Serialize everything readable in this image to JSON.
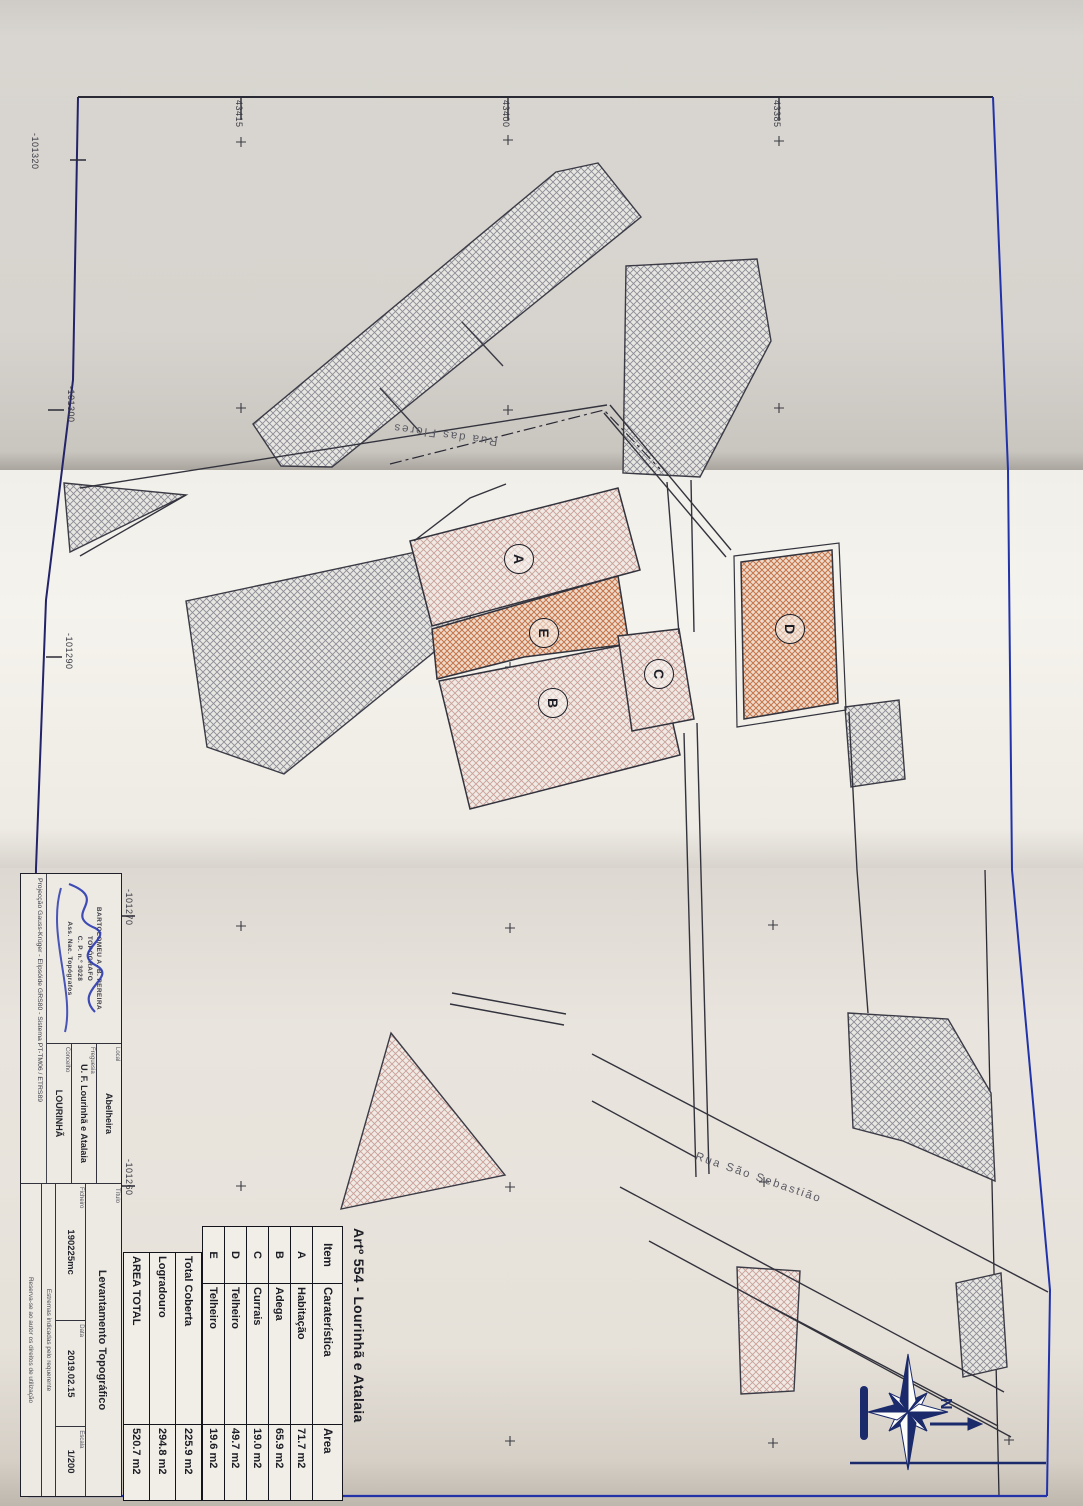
{
  "sheet": {
    "art_title": "Artº 554 - Lourinhã e Atalaia",
    "table": {
      "headers": [
        "Item",
        "Caraterística",
        "Area"
      ],
      "rows": [
        [
          "A",
          "Habitação",
          "71.7 m2"
        ],
        [
          "B",
          "Adega",
          "65.9 m2"
        ],
        [
          "C",
          "Currais",
          "19.0 m2"
        ],
        [
          "D",
          "Telheiro",
          "49.7 m2"
        ],
        [
          "E",
          "Telheiro",
          "19.6 m2"
        ]
      ],
      "totals": [
        [
          "Total Coberta",
          "225.9 m2"
        ],
        [
          "Logradouro",
          "294.8 m2"
        ],
        [
          "AREA TOTAL",
          "520.7 m2"
        ]
      ]
    },
    "title_block": {
      "stamp": [
        "BARTOLOMEU A. B. PEREIRA",
        "TOPÓGRAFO",
        "C. P. n.º 3028",
        "Ass. Nac. Topógrafos"
      ],
      "projection": "Projecção Gauss-Krüger - Elipsóide GRS80 - Sistema PT-TM06 / ETRS89",
      "fields": {
        "local_label": "Local",
        "local": "Abelheira",
        "freguesia_label": "Freguesia",
        "freguesia": "U. F. Lourinhã e Atalaia",
        "concelho_label": "Concelho",
        "concelho": "LOURINHÃ",
        "titulo_label": "Título",
        "titulo": "Levantamento Topográfico",
        "ficheiro_label": "Ficheiro",
        "ficheiro": "190225mc",
        "data_label": "Data",
        "data": "2019.02.15",
        "escala_label": "Escala",
        "escala": "1/200"
      },
      "notes": [
        "Estremas indicadas pelo requerente",
        "Reserva-se ao autor os direitos de utilização"
      ]
    },
    "plan": {
      "building_labels": [
        "A",
        "B",
        "C",
        "D",
        "E"
      ],
      "streets": [
        "Rua das Flores",
        "Rua São Sebastião"
      ],
      "north_label": "N",
      "grid_labels_top": [
        "43415",
        "43400",
        "43385"
      ],
      "grid_labels_left": [
        "-101320",
        "-101300",
        "-101290",
        "-101270",
        "-101260"
      ]
    },
    "colors": {
      "frame_blue": "#2233aa",
      "compass_navy": "#1b2a6b",
      "hatch_gray": "#8c8c96",
      "hatch_pink": "#c9a098",
      "hatch_orange": "#c5744a",
      "signature_blue": "#2a3ab0"
    }
  }
}
